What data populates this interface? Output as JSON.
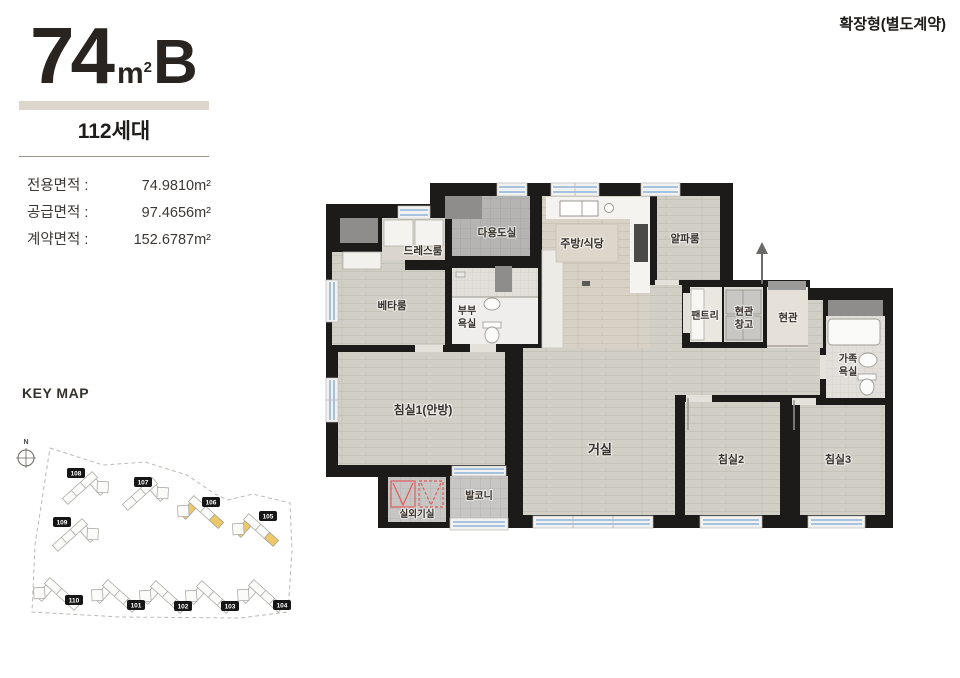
{
  "header": {
    "type_number": "74",
    "type_unit_base": "m",
    "type_unit_sup": "2",
    "type_letter": "B",
    "units_label": "112세대",
    "expansion_note": "확장형(별도계약)",
    "areas": [
      {
        "label": "전용면적 :",
        "value": "74.9810m²"
      },
      {
        "label": "공급면적 :",
        "value": "97.4656m²"
      },
      {
        "label": "계약면적 :",
        "value": "152.6787m²"
      }
    ]
  },
  "rooms": {
    "dress": "드레스룸",
    "utility": "다용도실",
    "kitchen": "주방/식당",
    "alpha": "알파룸",
    "beta": "베타룸",
    "bath_couple_l1": "부부",
    "bath_couple_l2": "욕실",
    "pantry": "팬트리",
    "storage_l1": "현관",
    "storage_l2": "창고",
    "entrance": "현관",
    "bath_family_l1": "가족",
    "bath_family_l2": "욕실",
    "bedroom1": "침실1(안방)",
    "living": "거실",
    "bedroom2": "침실2",
    "bedroom3": "침실3",
    "ac_room": "실외기실",
    "balcony": "발코니"
  },
  "keymap": {
    "title": "KEY MAP",
    "north_label": "N",
    "buildings": [
      {
        "id": "108",
        "highlighted": false
      },
      {
        "id": "107",
        "highlighted": false
      },
      {
        "id": "106",
        "highlighted": true
      },
      {
        "id": "105",
        "highlighted": true
      },
      {
        "id": "109",
        "highlighted": false
      },
      {
        "id": "110",
        "highlighted": false
      },
      {
        "id": "101",
        "highlighted": false
      },
      {
        "id": "102",
        "highlighted": false
      },
      {
        "id": "103",
        "highlighted": false
      },
      {
        "id": "104",
        "highlighted": false
      }
    ]
  },
  "colors": {
    "wall": "#1d1b19",
    "accent_yellow": "#ecc868",
    "window_blue": "#8fb3da",
    "ac_mark_red": "#e05c5c",
    "title_bar_beige": "#dcd6cc"
  }
}
